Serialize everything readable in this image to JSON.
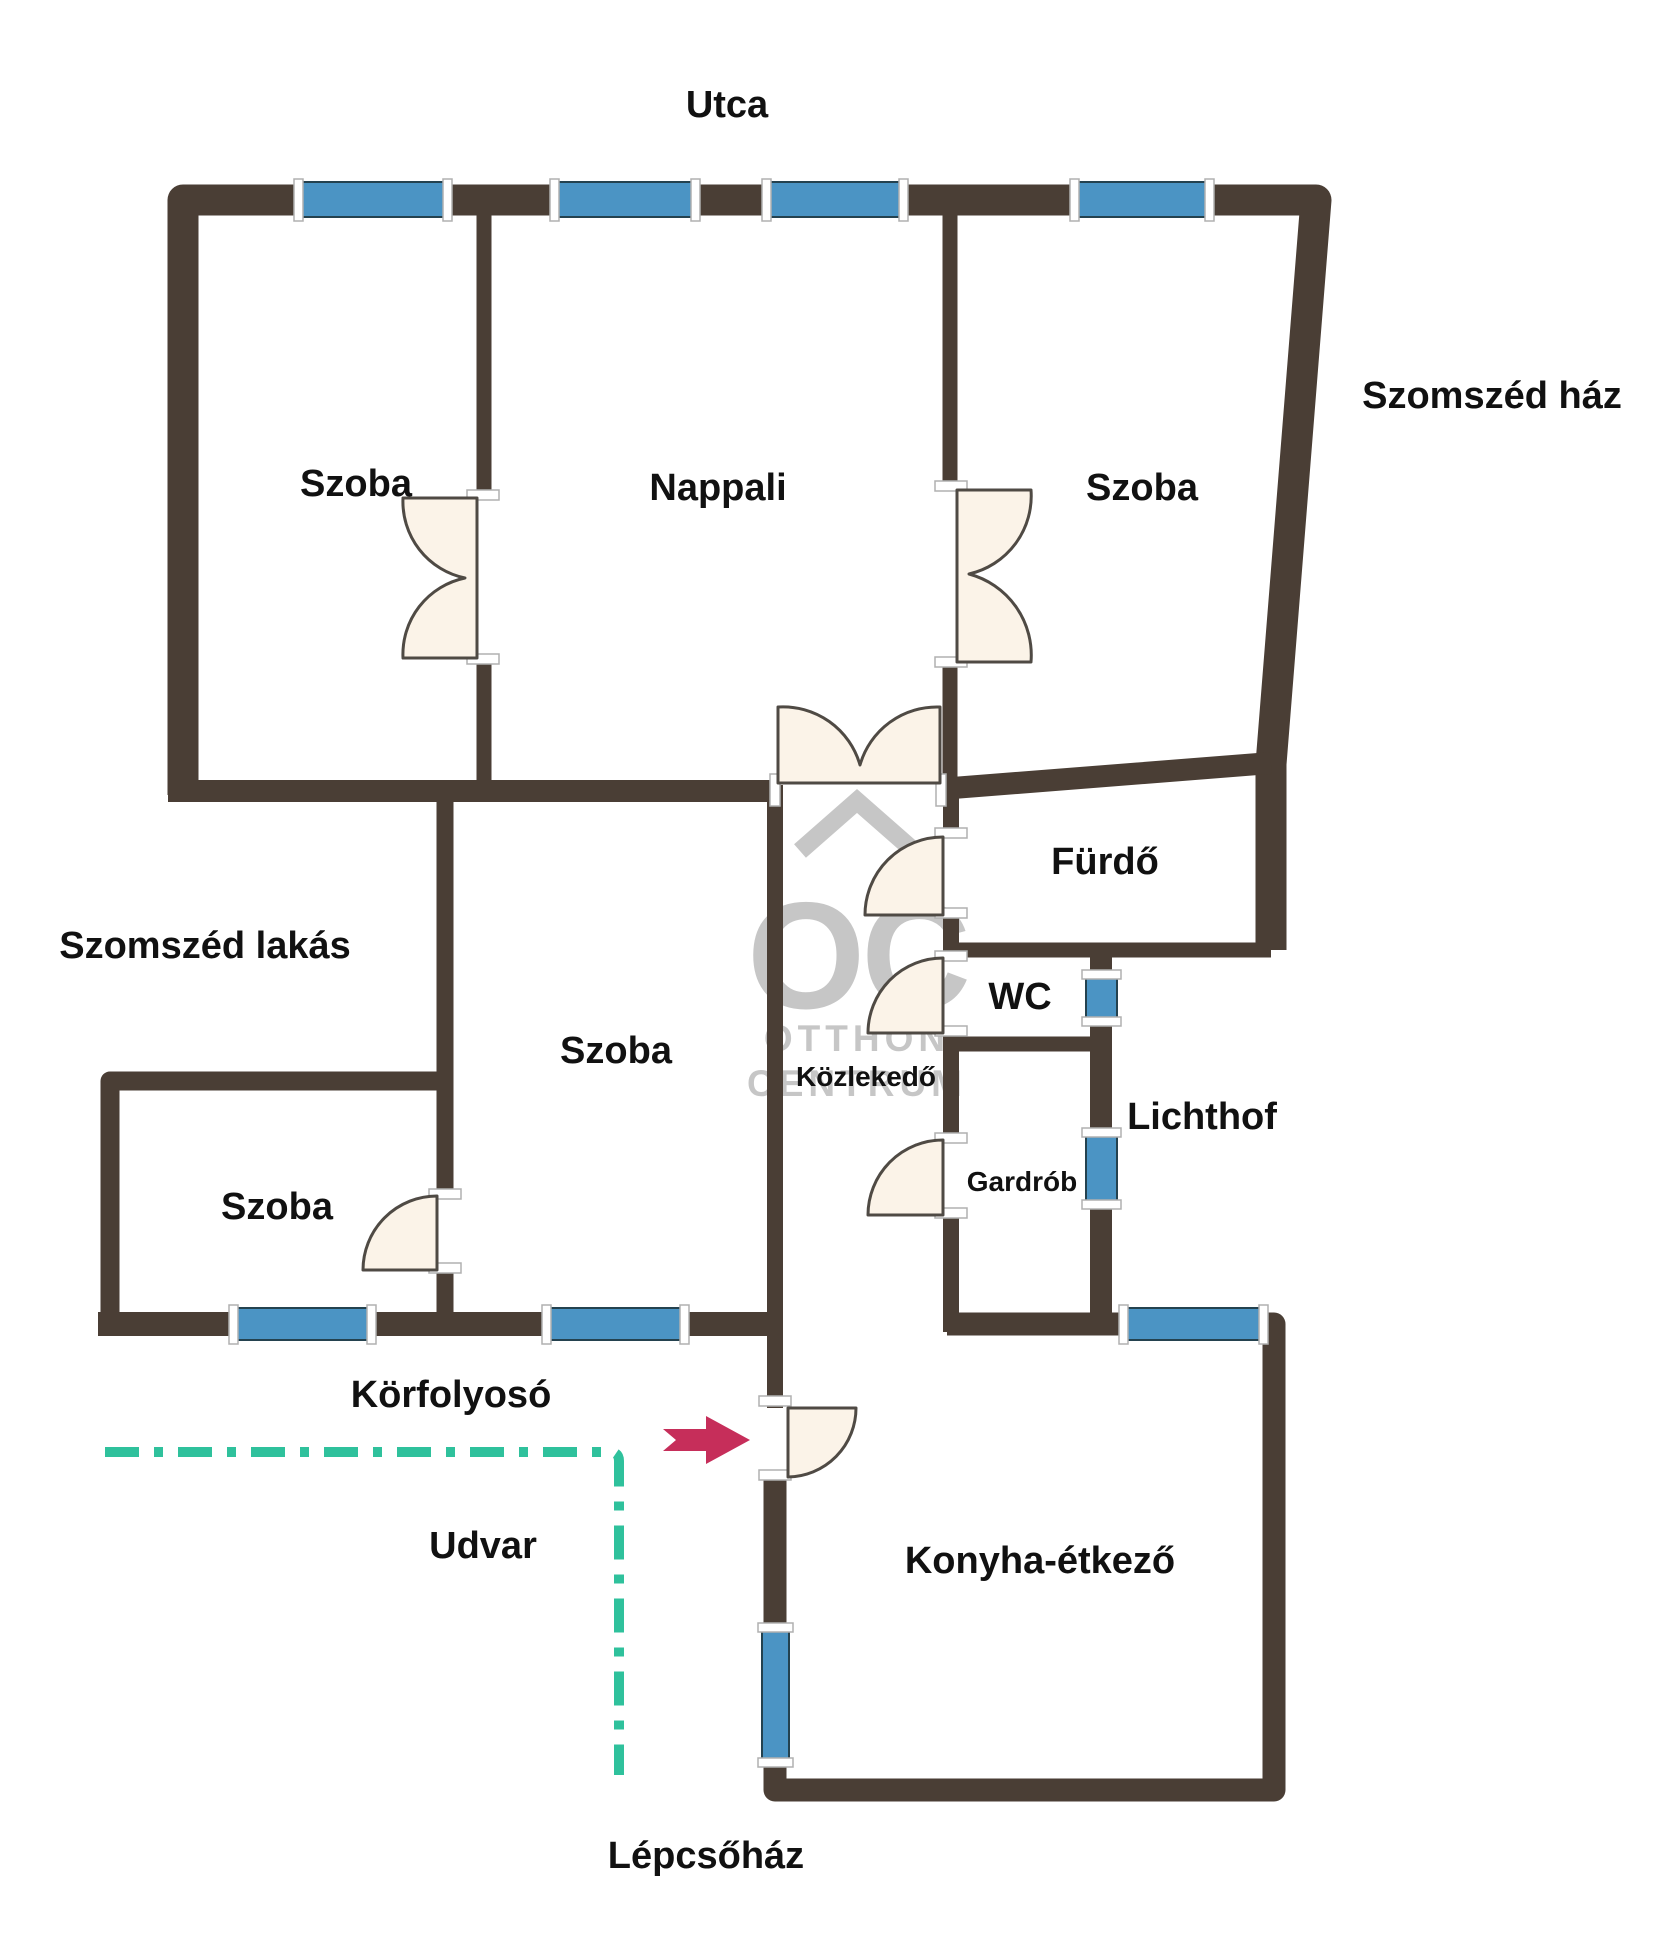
{
  "plan_type": "apartment-floor-plan",
  "colors": {
    "background": "#ffffff",
    "wall": "#4a3e35",
    "window": "#4b94c4",
    "window_tick": "#ffffff",
    "door_fill": "#fbf3e8",
    "door_stroke": "#4f4a44",
    "entrance_arrow": "#c62e5a",
    "courtyard_boundary": "#2fc19c",
    "watermark": "#c6c6c6",
    "label": "#111111"
  },
  "outside_labels": {
    "street": "Utca",
    "neighbor_house": "Szomszéd ház",
    "neighbor_flat": "Szomszéd lakás",
    "outdoor_corridor": "Körfolyosó",
    "courtyard": "Udvar",
    "stairwell": "Lépcsőház"
  },
  "rooms": [
    {
      "id": "room-top-left",
      "label": "Szoba"
    },
    {
      "id": "living-room",
      "label": "Nappali"
    },
    {
      "id": "room-top-right",
      "label": "Szoba"
    },
    {
      "id": "room-middle",
      "label": "Szoba"
    },
    {
      "id": "room-small",
      "label": "Szoba"
    },
    {
      "id": "bathroom",
      "label": "Fürdő"
    },
    {
      "id": "toilet",
      "label": "WC"
    },
    {
      "id": "hallway",
      "label": "Közlekedő"
    },
    {
      "id": "wardrobe",
      "label": "Gardrób"
    },
    {
      "id": "lightwell",
      "label": "Lichthof"
    },
    {
      "id": "kitchen-dining",
      "label": "Konyha-étkező"
    }
  ],
  "watermark": {
    "icon": "house-chevron-icon",
    "line1": "OC",
    "line2": "OTTHON",
    "line3": "CENTRUM"
  },
  "icons": {
    "entrance": "entrance-arrow-icon"
  }
}
